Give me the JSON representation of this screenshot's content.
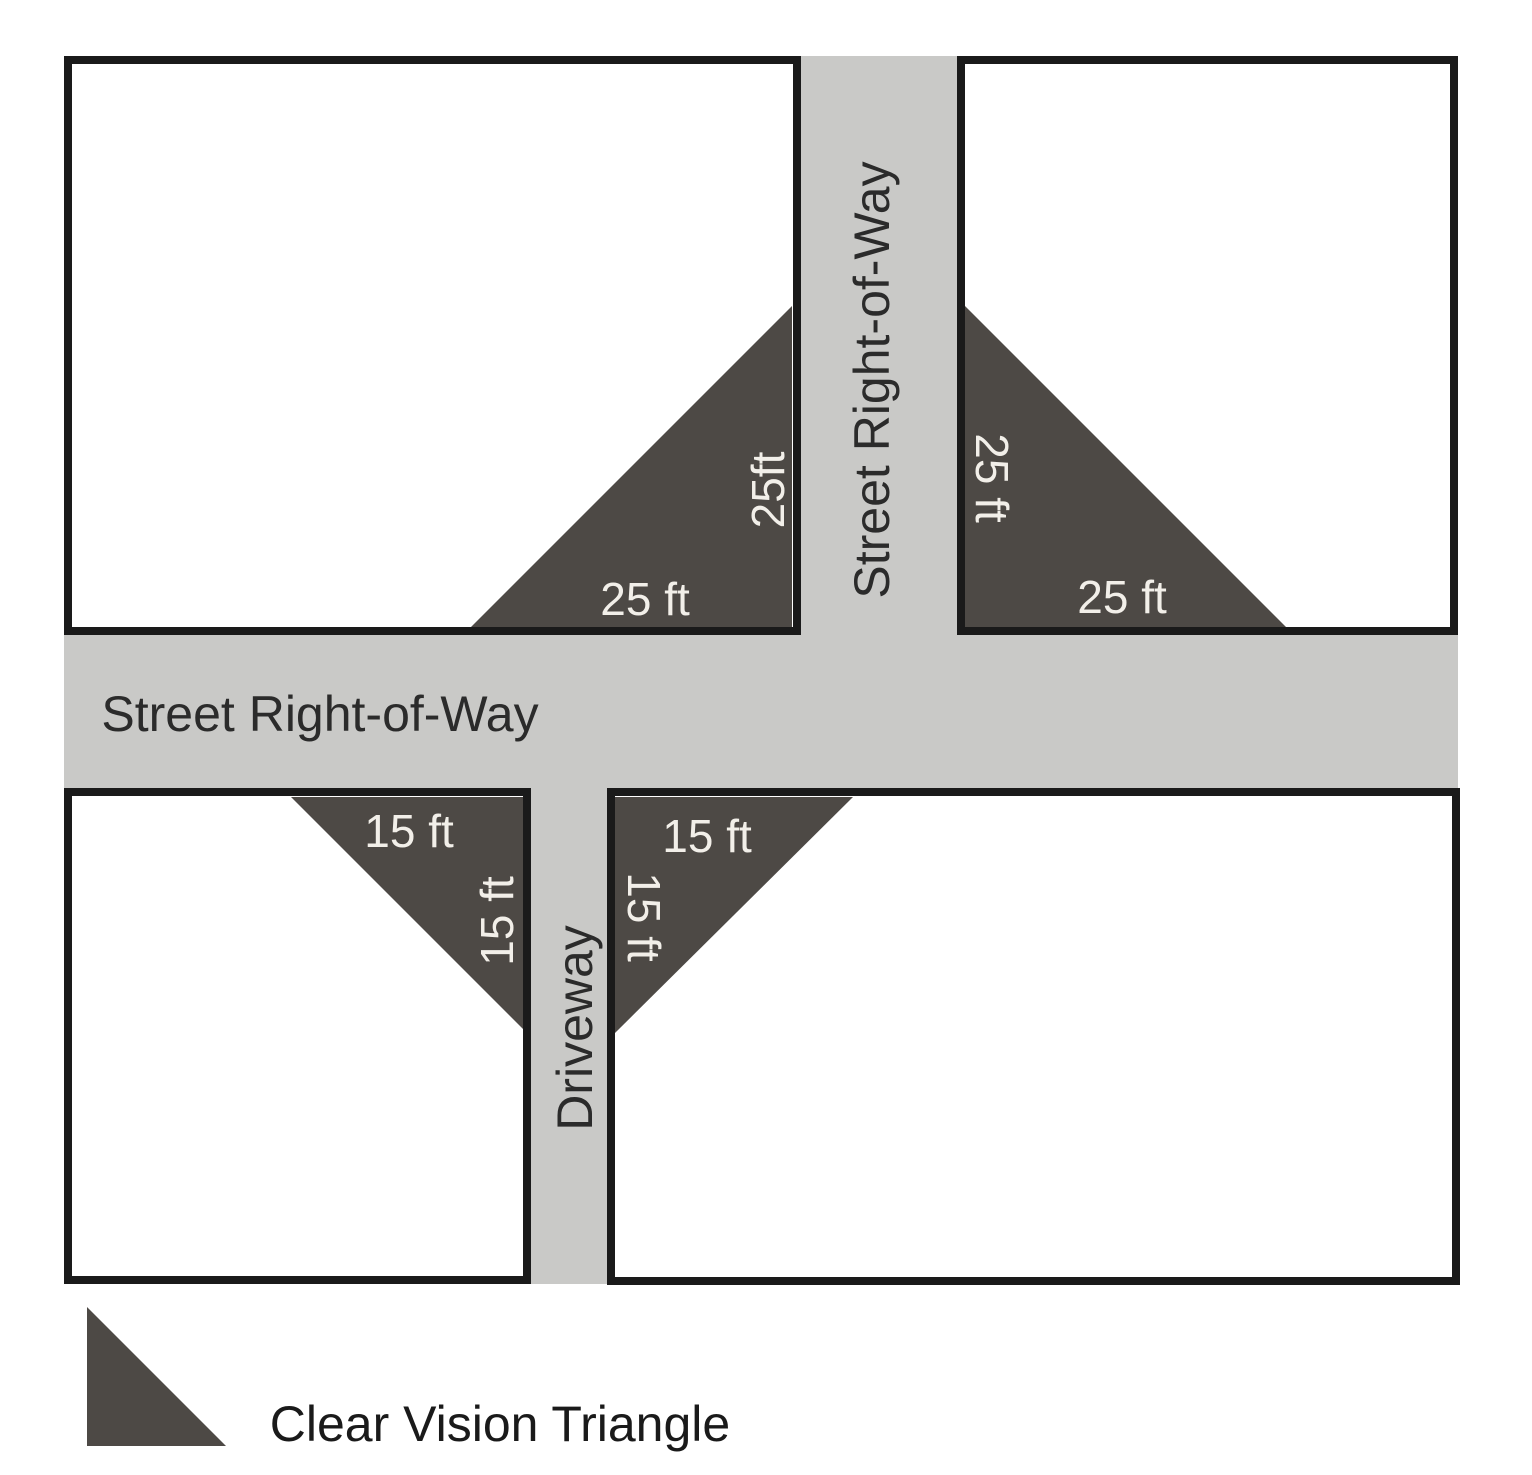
{
  "diagram": {
    "title_hint": "Clear vision triangle requirements at street and driveway intersections",
    "streets": {
      "horizontal_label": "Street Right-of-Way",
      "vertical_label": "Street Right-of-Way",
      "driveway_label": "Driveway"
    },
    "triangles": {
      "top_left": {
        "bottom_label": "25 ft",
        "side_label": "25ft"
      },
      "top_right": {
        "bottom_label": "25 ft",
        "side_label": "25 ft"
      },
      "bottom_left": {
        "top_label": "15 ft",
        "side_label": "15 ft"
      },
      "bottom_right": {
        "top_label": "15 ft",
        "side_label": "15 ft"
      }
    },
    "legend": {
      "label": "Clear Vision Triangle"
    },
    "colors": {
      "street_gray": "#c9c9c7",
      "triangle_dark": "#4d4945",
      "block_border": "#1a1a1a",
      "label_light": "#f2efe9",
      "label_dark": "#2b2b2b"
    }
  }
}
